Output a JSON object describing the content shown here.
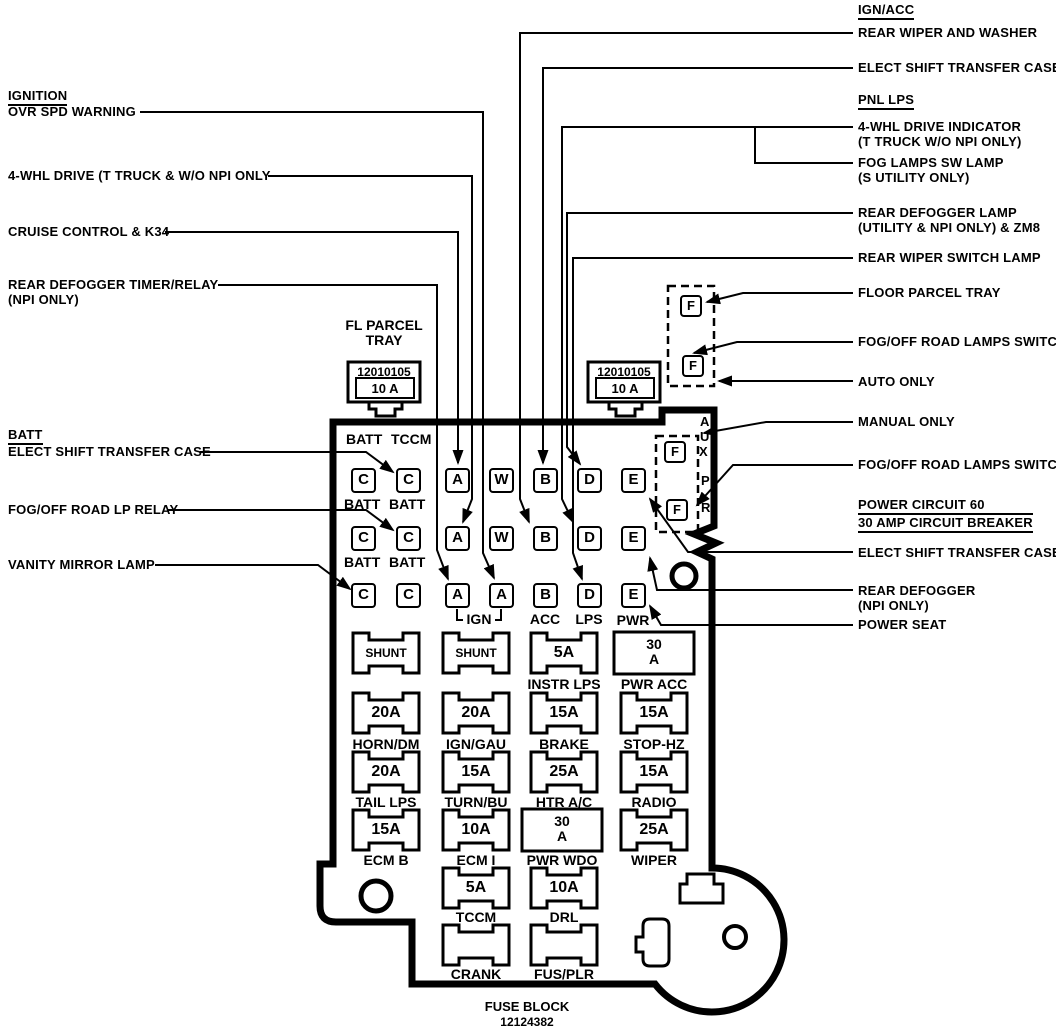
{
  "diagram": {
    "left_labels": [
      {
        "text": "IGNITION",
        "header": true
      },
      {
        "text": "OVR SPD WARNING"
      },
      {
        "text": "4-WHL DRIVE (T TRUCK & W/O NPI ONLY"
      },
      {
        "text": "CRUISE CONTROL & K34"
      },
      {
        "text": "REAR DEFOGGER TIMER/RELAY",
        "text2": "(NPI ONLY)"
      },
      {
        "text": "BATT",
        "header": true
      },
      {
        "text": "ELECT SHIFT TRANSFER CASE"
      },
      {
        "text": "FOG/OFF ROAD LP RELAY"
      },
      {
        "text": "VANITY MIRROR LAMP"
      }
    ],
    "right_labels": [
      {
        "text": "IGN/ACC",
        "header": true
      },
      {
        "text": "REAR WIPER AND WASHER"
      },
      {
        "text": "ELECT SHIFT TRANSFER CASE"
      },
      {
        "text": "PNL LPS",
        "header": true
      },
      {
        "text": "4-WHL DRIVE INDICATOR",
        "text2": "(T TRUCK W/O NPI ONLY)"
      },
      {
        "text": "FOG LAMPS SW LAMP",
        "text2": "(S UTILITY ONLY)"
      },
      {
        "text": "REAR DEFOGGER LAMP",
        "text2": "(UTILITY & NPI ONLY) & ZM8"
      },
      {
        "text": "REAR WIPER SWITCH LAMP"
      },
      {
        "text": "FLOOR PARCEL TRAY"
      },
      {
        "text": "FOG/OFF ROAD LAMPS SWITCH"
      },
      {
        "text": "AUTO ONLY"
      },
      {
        "text": "MANUAL ONLY"
      },
      {
        "text": "FOG/OFF ROAD LAMPS SWITCH"
      },
      {
        "text": "POWER CIRCUIT 60",
        "text2": "30 AMP CIRCUIT BREAKER",
        "header": true
      },
      {
        "text": "ELECT SHIFT TRANSFER CASE"
      },
      {
        "text": "REAR DEFOGGER",
        "text2": "(NPI ONLY)"
      },
      {
        "text": "POWER SEAT"
      }
    ],
    "relays": {
      "caption_line1": "FL PARCEL",
      "caption_line2": "TRAY",
      "left": {
        "part": "12010105",
        "amp": "10 A"
      },
      "right": {
        "part": "12010105",
        "amp": "10 A"
      }
    },
    "block": {
      "corner_header": [
        "BATT",
        "TCCM"
      ],
      "row1_letters": [
        "C",
        "C",
        "A",
        "W",
        "B",
        "D",
        "E"
      ],
      "row1_caption": [
        "BATT",
        "BATT"
      ],
      "row2_letters": [
        "C",
        "C",
        "A",
        "W",
        "B",
        "D",
        "E"
      ],
      "row2_caption": [
        "BATT",
        "BATT"
      ],
      "row3_letters": [
        "C",
        "C",
        "A",
        "A",
        "B",
        "D",
        "E"
      ],
      "row3_captions": [
        "IGN",
        "ACC",
        "LPS",
        "PWR"
      ],
      "aux_letters": [
        "A",
        "U",
        "X",
        "P",
        "R"
      ],
      "f_terminals": [
        "F",
        "F",
        "F",
        "F"
      ],
      "fuses": [
        {
          "amp": "SHUNT",
          "label": ""
        },
        {
          "amp": "SHUNT",
          "label": ""
        },
        {
          "amp": "5A",
          "label": "INSTR LPS"
        },
        {
          "amp": "30",
          "amp2": "A",
          "label": "PWR ACC"
        },
        {
          "amp": "20A",
          "label": "HORN/DM"
        },
        {
          "amp": "20A",
          "label": "IGN/GAU"
        },
        {
          "amp": "15A",
          "label": "BRAKE"
        },
        {
          "amp": "15A",
          "label": "STOP-HZ"
        },
        {
          "amp": "20A",
          "label": "TAIL LPS"
        },
        {
          "amp": "15A",
          "label": "TURN/BU"
        },
        {
          "amp": "25A",
          "label": "HTR A/C"
        },
        {
          "amp": "15A",
          "label": "RADIO"
        },
        {
          "amp": "15A",
          "label": "ECM B"
        },
        {
          "amp": "10A",
          "label": "ECM I"
        },
        {
          "amp": "30",
          "amp2": "A",
          "label": "PWR WDO"
        },
        {
          "amp": "25A",
          "label": "WIPER"
        },
        {
          "amp": "5A",
          "label": "TCCM"
        },
        {
          "amp": "10A",
          "label": "DRL"
        },
        {
          "amp": "",
          "label": "CRANK"
        },
        {
          "amp": "",
          "label": "FUS/PLR"
        }
      ],
      "footer": {
        "line1": "FUSE BLOCK",
        "line2": "12124382"
      }
    }
  }
}
